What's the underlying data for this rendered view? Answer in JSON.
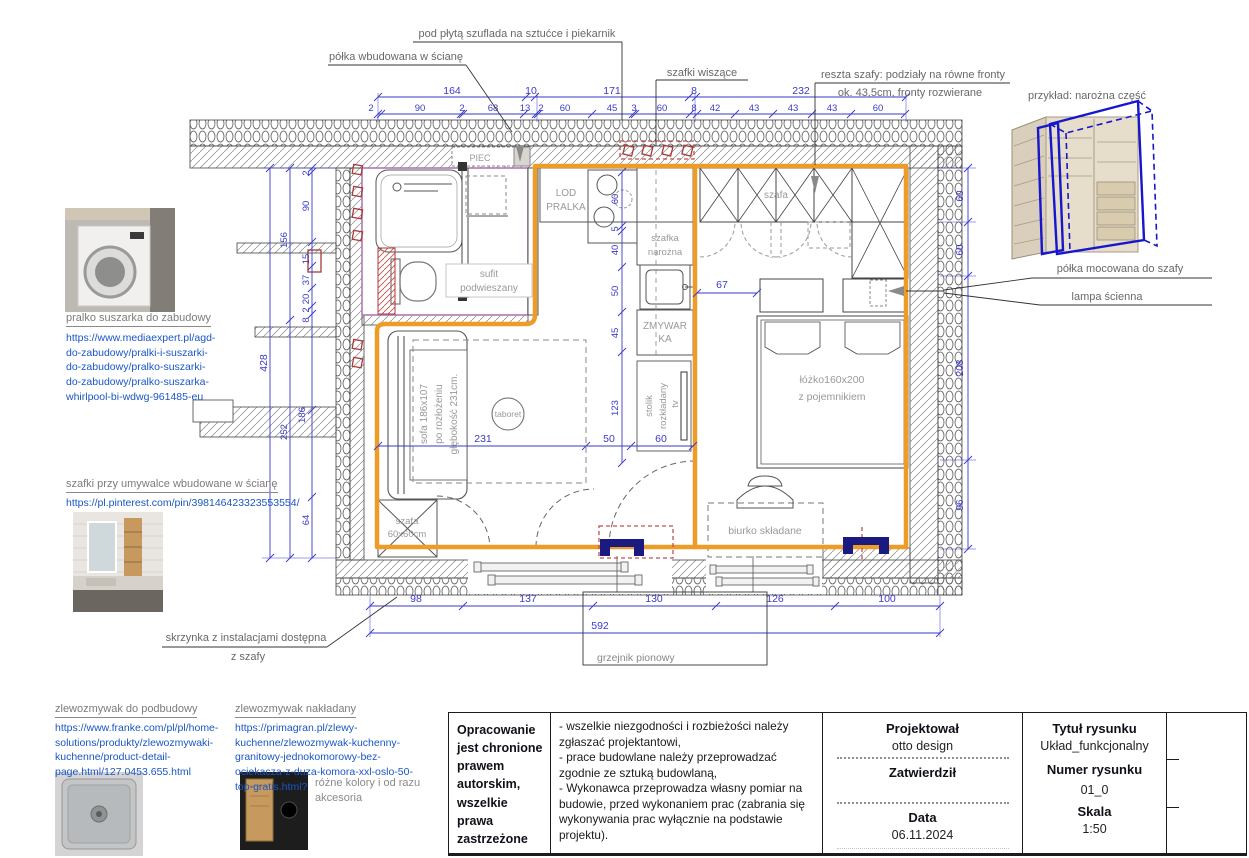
{
  "colors": {
    "accent_orange": "#EE9C28",
    "dim_blue": "#3A3AC8",
    "navy_radiator": "#1A1A80",
    "link_blue": "#1A56C4",
    "symbol_red": "#B03535",
    "wireframe_blue": "#1616CC"
  },
  "callouts": {
    "drawer_under_hob": "pod płytą szuflada na sztućce i piekarnik",
    "shelf_in_wall": "półka wbudowana w ścianę",
    "hanging_cabinets": "szafki wiszące",
    "wardrobe_fronts_1": "reszta szafy: podziały na równe fronty",
    "wardrobe_fronts_2": "ok. 43,5cm, fronty rozwierane",
    "corner_example": "przykład: narożna część",
    "shelf_on_wardrobe": "półka mocowana do szafy",
    "wall_lamp": "lampa ścienna",
    "utility_box_1": "skrzynka z instalacjami dostępna",
    "utility_box_2": "z szafy",
    "radiator": "grzejnik pionowy"
  },
  "plan": {
    "piec": "PIEC",
    "lod": "LOD",
    "pralka": "PRALKA",
    "szafka_narozna_1": "szafka",
    "szafka_narozna_2": "narożna",
    "zmywarka_1": "ZMYWAR",
    "zmywarka_2": "KA",
    "sufit_1": "sufit",
    "sufit_2": "podwieszany",
    "szafa": "szafa",
    "sofa_1": "sofa 186x107",
    "sofa_2": "po rozłożeniu",
    "sofa_3": "głębokość 231cm.",
    "taboret": "taboret",
    "stolik_1": "stolik",
    "stolik_2": "rozkładany",
    "tv": "tv",
    "szafa60_1": "szafa",
    "szafa60_2": "60x60cm",
    "lozko_1": "łóżko160x200",
    "lozko_2": "z pojemnikiem",
    "biurko": "biurko składane"
  },
  "dims": {
    "top1": [
      "164",
      "10",
      "171",
      "8",
      "232"
    ],
    "top2": [
      "2",
      "90",
      "2",
      "68",
      "13",
      "2",
      "60",
      "45",
      "3",
      "60",
      "8",
      "42",
      "43",
      "43",
      "43",
      "60"
    ],
    "left": [
      "2",
      "90",
      "156",
      "15",
      "37",
      "20",
      "2",
      "8",
      "428",
      "186",
      "252",
      "64"
    ],
    "kitchen": [
      "60",
      "5",
      "40",
      "50",
      "45",
      "123"
    ],
    "mid": [
      "231",
      "50",
      "60"
    ],
    "bed": "67",
    "right": [
      "60",
      "60",
      "208",
      "96"
    ],
    "bottom": [
      "98",
      "137",
      "130",
      "126",
      "100"
    ],
    "bottom_total": "592"
  },
  "refs": {
    "washer": {
      "title": "pralko suszarka do zabudowy",
      "url": "https://www.mediaexpert.pl/agd-do-zabudowy/pralki-i-suszarki-do-zabudowy/pralko-suszarki-do-zabudowy/pralko-suszarka-whirlpool-bi-wdwg-961485-eu"
    },
    "sink_mirror": {
      "title": "szafki przy umywalce wbudowane w ścianę",
      "url": "https://pl.pinterest.com/pin/398146423323553554/"
    },
    "sink_under": {
      "title": "zlewozmywak do podbudowy",
      "url": "https://www.franke.com/pl/pl/home-solutions/produkty/zlewozmywaki-kuchenne/product-detail-page.html/127.0453.655.html"
    },
    "sink_top": {
      "title": "zlewozmywak nakładany",
      "url": "https://primagran.pl/zlewy-kuchenne/zlewozmywak-kuchenny-granitowy-jednokomorowy-bez-ociekacza-z-duza-komora-xxl-oslo-50-top-gratis.html?",
      "note": "różne kolory i od razu akcesoria"
    }
  },
  "titleblock": {
    "copyright": "Opracowanie jest chronione prawem autorskim, wszelkie prawa zastrzeżone",
    "notes_1": "- wszelkie niezgodności i rozbieżości należy zgłaszać projektantowi,",
    "notes_2": "- prace budowlane należy przeprowadzać zgodnie ze sztuką budowlaną,",
    "notes_3": "- Wykonawca przeprowadza własny pomiar na budowie, przed wykonaniem prac (zabrania się wykonywania prac wyłącznie na podstawie projektu).",
    "designed_label": "Projektował",
    "designed_value": "otto design",
    "approved_label": "Zatwierdził",
    "date_label": "Data",
    "date_value": "06.11.2024",
    "title_label": "Tytuł rysunku",
    "title_value": "Układ_funkcjonalny",
    "number_label": "Numer rysunku",
    "number_value": "01_0",
    "scale_label": "Skala",
    "scale_value": "1:50"
  }
}
